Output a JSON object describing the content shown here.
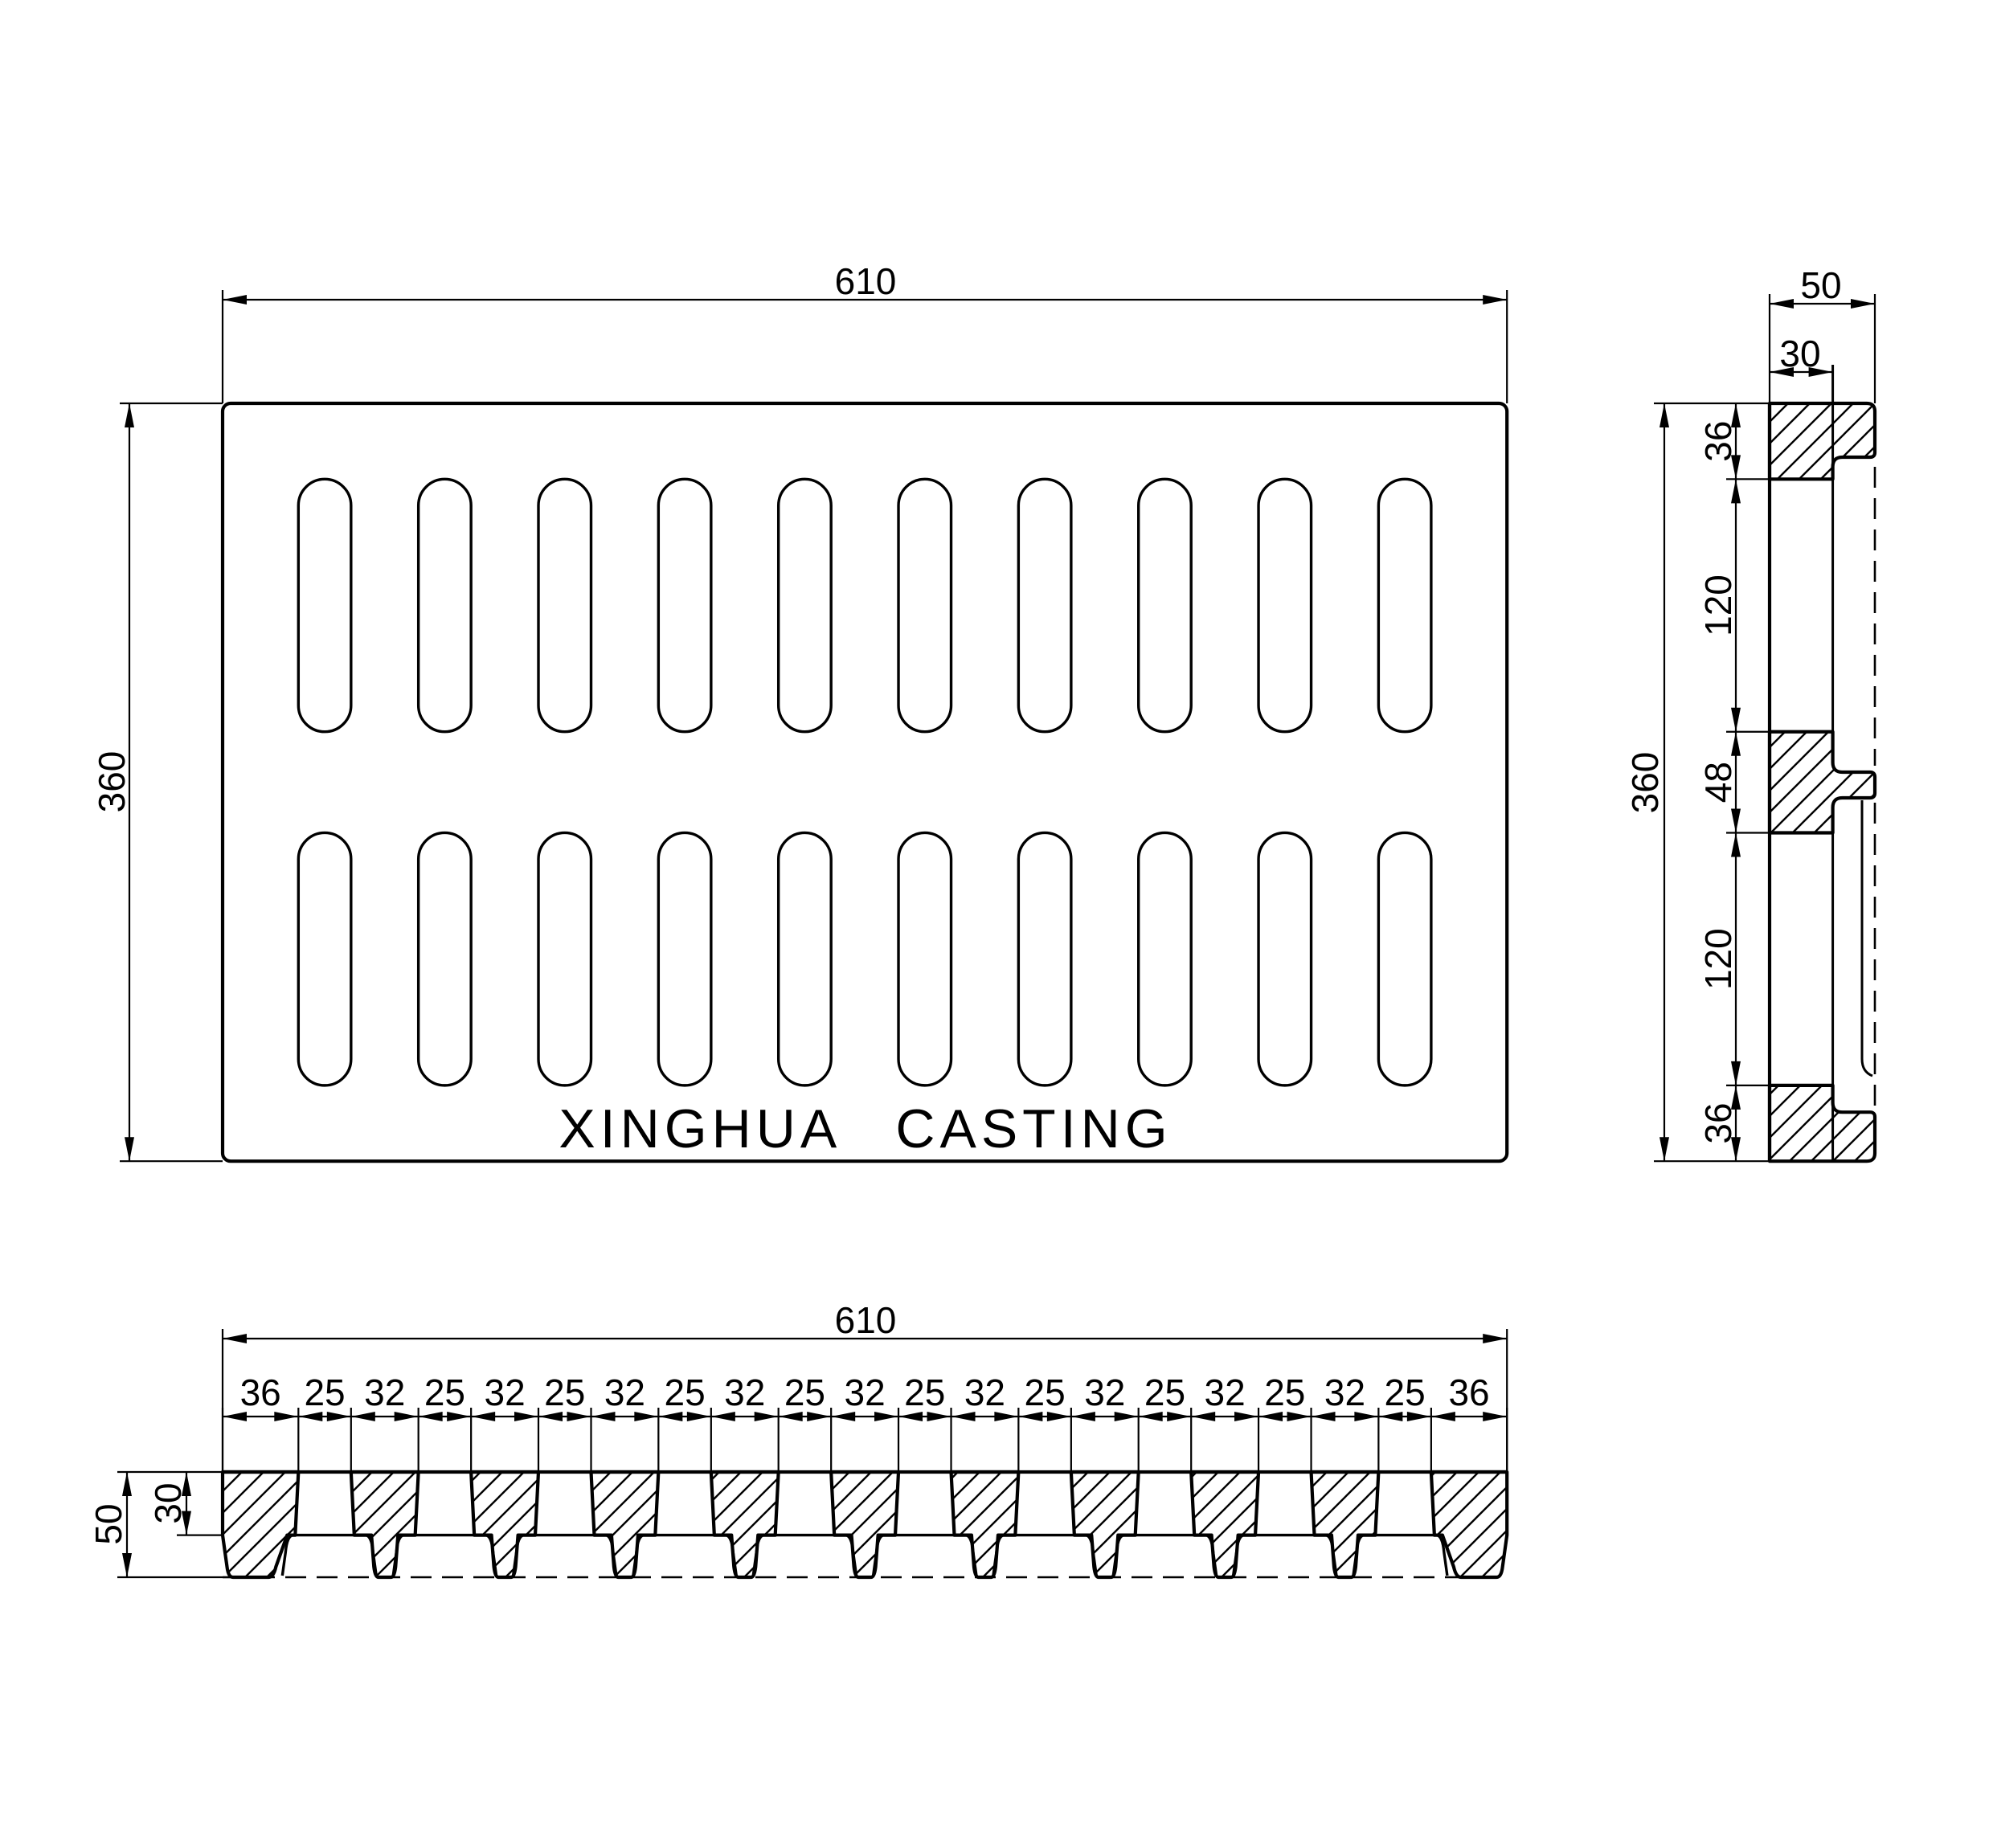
{
  "page": {
    "background_color": "#ffffff",
    "line_color": "#000000",
    "type_label": "engineering drawing, third-angle multi-view of cast drain grate"
  },
  "views": {
    "plan": {
      "name": "plan view",
      "width_label": "610",
      "height_label": "360",
      "brand_text": "XINGHUA CASTING",
      "slot_rows": 2,
      "slot_cols": 10
    },
    "side": {
      "name": "side section view",
      "width_label": "50",
      "web_label": "30",
      "height_label": "360",
      "segments_mm": [
        36,
        120,
        48,
        120,
        36
      ]
    },
    "bottom": {
      "name": "bottom section view",
      "width_label": "610",
      "height_label": "50",
      "plate_label": "30",
      "segments_mm": [
        36,
        25,
        32,
        25,
        32,
        25,
        32,
        25,
        32,
        25,
        32,
        25,
        32,
        25,
        32,
        25,
        32,
        25,
        32,
        25,
        36
      ]
    }
  }
}
